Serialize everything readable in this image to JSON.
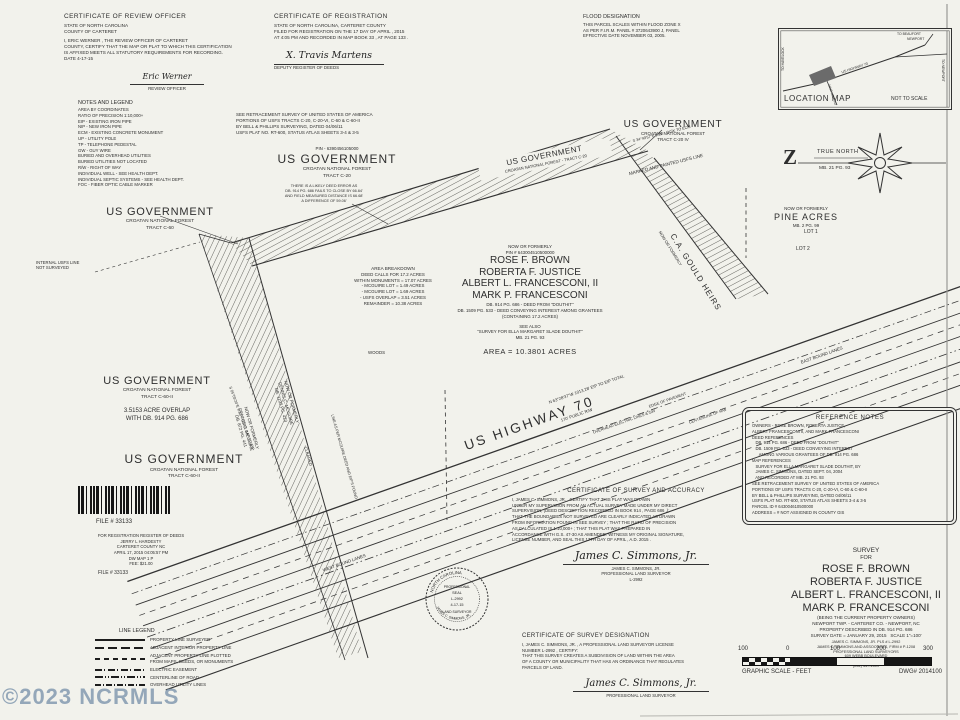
{
  "watermark": "©2023 NCRMLS",
  "review_cert": {
    "title": "CERTIFICATE OF REVIEW OFFICER",
    "lines": [
      "STATE OF NORTH CAROLINA",
      "COUNTY OF CARTERET"
    ],
    "body": [
      "I,  ERIC WERNER ,  THE REVIEW OFFICER OF  CARTERET",
      "COUNTY, CERTIFY THAT THE MAP OR PLAT TO WHICH THIS CERTIFICATION",
      "IS AFFIXED MEETS ALL STATUTORY REQUIREMENTS FOR RECORDING.",
      "DATE   4-17-15"
    ],
    "signature": "Eric Werner",
    "signature_label": "REVIEW OFFICER"
  },
  "registration_cert": {
    "title": "CERTIFICATE OF REGISTRATION",
    "body": [
      "STATE OF NORTH CAROLINA, CARTERET COUNTY",
      "FILED FOR REGISTRATION ON THE  17  DAY OF  APRIL ,  2015",
      "AT  4:05  PM AND RECORDED IN MAP BOOK  33 , AT PAGE  133 ."
    ],
    "signature": "X. Travis Martens",
    "signature_label": "DEPUTY REGISTER OF DEEDS"
  },
  "flood_note": {
    "title": "FLOOD DESIGNATION",
    "lines": [
      "THIS PARCEL SCALES WITHIN FLOOD ZONE X",
      "AS PER F.I.R.M. PANEL # 3720643900 J, PANEL",
      "EFFECTIVE DATE NOVEMBER 03, 2005."
    ]
  },
  "location_map": {
    "title": "LOCATION MAP",
    "scale": "NOT TO SCALE",
    "labels": {
      "to_havelock": "TO HAVELOCK",
      "to_beaufort": "TO BEAUFORT",
      "newport": "NEWPORT",
      "to_newport": "TO NEWPORT",
      "highway": "US HIGHWAY 70",
      "nine_mile": "NINE MILE RD"
    }
  },
  "north_arrow": {
    "letter": "Z",
    "label": "TRUE NORTH",
    "ref": "MB. 21 PG. 93"
  },
  "notes_legend": {
    "title": "NOTES AND LEGEND",
    "lines": [
      "AREA BY COORDINATES",
      "RATIO OF PRECISION 1:10,000+",
      "EIP - EXISTING IRON PIPE",
      "NIP - NEW IRON PIPE",
      "ECM - EXISTING CONCRETE MONUMENT",
      "UP - UTILITY POLE",
      "TP - TELEPHONE PEDESTAL",
      "GW - GUY WIRE",
      "BURIED AND OVERHEAD UTILITIES",
      "BURIED UTILITIES NOT LOCATED",
      "R/W - RIGHT OF WAY",
      "INDIVIDUAL WELL - SEE HEALTH DEPT.",
      "INDIVIDUAL SEPTIC SYSTEMS - SEE HEALTH DEPT.",
      "FOC - FIBER OPTIC CABLE MARKER"
    ]
  },
  "usfs_note": {
    "lines": [
      "SEE RETRACEMENT SURVEY OF UNITED STATES OF AMERICA",
      "PORTIONS OF USFS TRACTS C-20, C-20-VI, C-60 & C-60-II",
      "BY BELL & PHILLIPS SURVEYING, DATED 04/06/11",
      "USFS PLAT NO. RT-600, STATUS ATLAS SHEETS 3-4 & 3-5"
    ]
  },
  "tracts": {
    "c60": {
      "name": "US GOVERNMENT",
      "forest": "CROATAN NATIONAL FOREST",
      "tract": "TRACT C-60"
    },
    "c20": {
      "pin": "PIN - 6390456105000",
      "name": "US GOVERNMENT",
      "forest": "CROATAN NATIONAL FOREST",
      "tract": "TRACT C-20"
    },
    "c20iv": {
      "name": "US GOVERNMENT",
      "forest": "CROATAN NATIONAL FOREST",
      "tract": "TRACT C-20 IV"
    },
    "band": {
      "name": "US GOVERNMENT",
      "forest": "CROATAN NATIONAL FOREST - TRACT C-20"
    },
    "c60ii_a": {
      "name": "US GOVERNMENT",
      "forest": "CROATAN NATIONAL FOREST",
      "tract": "TRACT C-60-II",
      "overlap1": "3.5153 ACRE OVERLAP",
      "overlap2": "WITH DB. 914 PG. 686"
    },
    "c60ii_b": {
      "name": "US GOVERNMENT",
      "forest": "CROATAN NATIONAL FOREST",
      "tract": "TRACT C-60-II"
    },
    "pine": {
      "nof": "NOW OR FORMERLY",
      "name": "PINE ACRES",
      "ref": "MB. 2 PG. 99"
    }
  },
  "owner_block": {
    "nof": "NOW OR FORMERLY",
    "pin": "PIN # 643004510500000",
    "names": [
      "ROSE F. BROWN",
      "ROBERTA F. JUSTICE",
      "ALBERT L. FRANCESCONI, II",
      "MARK P. FRANCESCONI"
    ],
    "deeds": [
      "DB. 914 PG. 686 - DEED FROM \"DOUTHIT\"",
      "DB. 1509 PG. 533 - DEED CONVEYING INTEREST AMONG GRANTEES",
      "(CONTAINING 17.2 ACRES)"
    ],
    "see_also": [
      "SEE ALSO",
      "\"SURVEY FOR ELLA MARGARET SLADE DOUTHIT\"",
      "MB. 21 PG. 93"
    ],
    "area": "AREA = 10.3801 ACRES"
  },
  "area_breakdown": {
    "title": "AREA BREAKDOWN",
    "lines": [
      "DEED CALLS FOR 17.2 ACRES",
      "WITHIN MONUMENTS = 17.07 ACRES",
      "- MCGUIRE LOT = 1.49 ACRES",
      "- MCGUIRE LOT = 1.69 ACRES",
      "- USFS OVERLAP = 3.51 ACRES",
      "REMAINDER = 10.38 ACRES"
    ]
  },
  "deed_error": [
    "THERE IS A LIKELY DEED ERROR AS",
    "DB. 914 PG. 686 FAILS TO CLOSE BY 66.64'",
    "AND FIELD MEASURED DISTANCE IS 66.68'",
    "A DIFFERENCE OF 59.06'"
  ],
  "labels": {
    "highway": "US HIGHWAY 70",
    "east_lanes": "EAST BOUND LANES",
    "west_lanes": "WEST BOUND LANES",
    "edge_pavement": "EDGE OF PAVEMENT",
    "centerline_rw": "CENTERLINE OF R/W",
    "overhead": "OVERHEAD ELECTRIC LINES & GW",
    "bearing_total": "N 63°28'37\"W  1013.28'  EIP TO EIP TOTAL",
    "public_rw": "170' PUBLIC R/W",
    "marked_painted": "MARKED AND PAINTED USFS LINE",
    "mcguire1": [
      "NOW OR FORMERLY",
      "DENNIS C. MCGUIRE",
      "DB. 1192 PG. 423"
    ],
    "mcguire2": [
      "NOW OR FORMERLY",
      "DENNIS C. MCGUIRE",
      "DB. 872 PG. 441"
    ],
    "mcguire_line": "LINE AS PER MCGUIRE DEED AND EIP'S FOUND",
    "internal_usfs": [
      "INTERNAL USFS LINE",
      "NOT SURVEYED"
    ],
    "gould_nof": "NOW OR FORMERLY",
    "gould_name": "C.A. GOULD HEIRS",
    "lot1": "LOT 1",
    "lot2": "LOT 2",
    "woods": "WOODS",
    "cleared": "CLEARED",
    "ecm_tie": "S 34°49'57\"E 9.39' - DISK TO ECM",
    "usfs_cap_tie": "S 05°09'24\"E 0.33' - USFS CAP TO EIP"
  },
  "reference_notes": {
    "title": "REFERENCE NOTES",
    "lines": [
      "OWNERS - ROSE BROWN, ROBERTA JUSTICE,",
      "ALBERT FRANCESCONI II, AND MARK FRANCESCONI",
      "DEED REFERENCES",
      "   DB. 914 PG. 686 - DEED FROM \"DOUTHIT\"",
      "   DB. 1509 PG. 533 - DEED CONVEYING INTEREST",
      "      AMONG VARIOUS GRANTEES OF DB. 914 PG. 686",
      "MAP REFERENCES",
      "   SURVEY FOR ELLA MARGARET SLADE DOUTHIT, BY",
      "   JAMES C. SIMMONS, DATED SEPT. 04, 2004",
      "   AND RECORDED AT MB. 21 PG. 93",
      "SEE RETRACEMENT SURVEY OF UNITED STATES OF AMERICA",
      "PORTIONS OF USFS TRACTS C-20, C-20-VI, C-60 & C-60-II",
      "BY BELL & PHILLIPS SURVEYING, DATED 04/06/11",
      "USFS PLAT NO. RT-600, STATUS ATLAS SHEETS 3-4 & 3-5",
      "PARCEL ID # 643004610500000",
      "ADDRESS = # NOT ASSIGNED IN COUNTY GIS"
    ]
  },
  "accuracy_cert": {
    "title": "CERTIFICATE OF SURVEY AND ACCURACY",
    "body": [
      "I,  JAMES C. SIMMONS, JR. ,  CERTIFY THAT THIS PLAT WAS DRAWN",
      "UNDER MY SUPERVISION FROM AN ACTUAL SURVEY MADE UNDER MY DIRECT",
      "SUPERVISION, (DEED DESCRIPTION RECORDED IN BOOK  914 , PAGE  686 ,);",
      "THAT THE BOUNDARIES NOT SURVEYED ARE CLEARLY INDICATED AS DRAWN",
      "FROM INFORMATION FOUND IN  SEE SURVEY ; THAT THE RATIO OF PRECISION",
      "AS CALCULATED IS  1:10,000+ ; THAT THIS PLAT WAS PREPARED IN",
      "ACCORDANCE WITH G.S. 47-30 AS AMENDED. WITNESS MY ORIGINAL SIGNATURE,",
      "LICENSE NUMBER, AND SEAL THIS  17TH  DAY OF  APRIL ,  A.D.  2015 ."
    ],
    "signature": "James C. Simmons, Jr.",
    "name": "JAMES C. SIMMONS, JR.",
    "role": "PROFESSIONAL LAND SURVEYOR",
    "license": "L-2992"
  },
  "designation_cert": {
    "title": "CERTIFICATE OF SURVEY DESIGNATION",
    "body": [
      "I,  JAMES C. SIMMONS, JR. ,  A PROFESSIONAL LAND SURVEYOR LICENSE",
      "NUMBER  L-2992 ,  CERTIFY:",
      "THAT THIS SURVEY CREATES A SUBDIVISION OF LAND WITHIN THE AREA",
      "OF A COUNTY OR MUNICIPALITY THAT HAS AN ORDINANCE THAT REGULATES",
      "PARCELS OF LAND."
    ],
    "signature": "James C. Simmons, Jr.",
    "role": "PROFESSIONAL LAND SURVEYOR"
  },
  "seal": {
    "state": "NORTH CAROLINA",
    "name": "JAMES C. SIMMONS, JR.",
    "line1": "PROFESSIONAL",
    "line2": "SEAL",
    "line3": "L-2992",
    "line4": "4-17-15",
    "line5": "LAND SURVEYOR"
  },
  "title_block": {
    "survey": "SURVEY",
    "for": "FOR",
    "names": [
      "ROSE F. BROWN",
      "ROBERTA F. JUSTICE",
      "ALBERT L. FRANCESCONI, II",
      "MARK P. FRANCESCONI"
    ],
    "sub": [
      "(BEING THE CURRENT PROPERTY OWNERS)",
      "NEWPORT TWP. - CARTERET CO. - NEWPORT, NC",
      "PROPERTY DESCRIBED IN DB. 914 PG. 686"
    ],
    "date_line": "SURVEY DATE = JANUARY 29, 2015",
    "scale": "SCALE 1\"=100'",
    "firm": [
      "JAMES C. SIMMONS, JR. PLS # L-2992",
      "JAMES C. SIMMONS AND ASSOCIATES, FIRM # P-1208",
      "PROFESSIONAL LAND SURVEYORS",
      "609 WEBB BOULEVARD",
      "HAVELOCK, NC 28532",
      "(252) 447-1509"
    ]
  },
  "scale_bar": {
    "ticks": [
      "100",
      "0",
      "100",
      "200",
      "300"
    ],
    "caption": "GRAPHIC SCALE - FEET",
    "dwg": "DWG# 2014100"
  },
  "line_legend": {
    "title": "LINE LEGEND",
    "items": [
      {
        "label": "PROPERTY LINE SURVEYED"
      },
      {
        "label": "ADJACENT INTERIOR PROPERTY LINE"
      },
      {
        "label": "ADJACENT PROPERTY LINE PLOTTED",
        "label2": "FROM MAPS, DEEDS, OR MONUMENTS"
      },
      {
        "label": "ELECTRIC EASEMENT"
      },
      {
        "label": "CENTERLINE OF ROAD"
      },
      {
        "label": "OVERHEAD UTILITY LINES"
      }
    ]
  },
  "file_stamp": {
    "file_no": "FILE # 33133",
    "lines": [
      "FOR REGISTRATION REGISTER OF DEEDS",
      "JERRY L HARDESTY",
      "CARTERET COUNTY NC",
      "APRIL 17, 2015  04:05:57 PM",
      "DW MAP   1 P",
      "FEE: $21.00"
    ],
    "file_no2": "FILE # 33133"
  }
}
